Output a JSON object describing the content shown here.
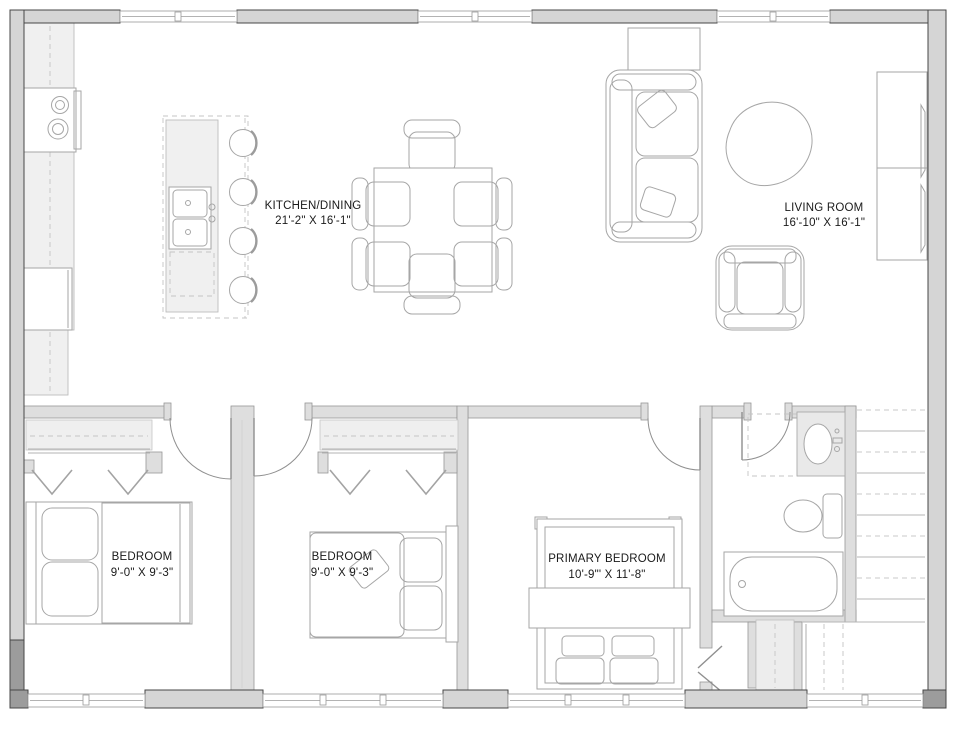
{
  "plan": {
    "rooms": [
      {
        "id": "kitchen_dining",
        "label": "KITCHEN/DINING",
        "dimensions": "21'-2\" X 16'-1\""
      },
      {
        "id": "living_room",
        "label": "LIVING ROOM",
        "dimensions": "16'-10\" X 16'-1\""
      },
      {
        "id": "bedroom_1",
        "label": "BEDROOM",
        "dimensions": "9'-0\" X 9'-3\""
      },
      {
        "id": "bedroom_2",
        "label": "BEDROOM",
        "dimensions": "9'-0\" X 9'-3\""
      },
      {
        "id": "primary_bedroom",
        "label": "PRIMARY BEDROOM",
        "dimensions": "10'-9\"' X 11'-8\""
      }
    ],
    "fixtures": {
      "kitchen": [
        "range-cooktop",
        "wall-counter",
        "island-double-sink",
        "dishwasher",
        "bar-stool",
        "bar-stool",
        "bar-stool",
        "bar-stool"
      ],
      "dining": [
        "dining-table",
        "dining-chairs-x6"
      ],
      "living": [
        "console-table",
        "sofa",
        "coffee-table",
        "armchair",
        "media-cabinet"
      ],
      "bedroom_1": [
        "bed",
        "closet-with-hangers"
      ],
      "bedroom_2": [
        "bed",
        "closet-with-hangers"
      ],
      "primary_bedroom": [
        "bed"
      ],
      "bathroom": [
        "vanity-sink",
        "toilet",
        "bathtub"
      ],
      "circulation": [
        "staircase",
        "under-stair-closet"
      ]
    },
    "colors": {
      "background": "#ffffff",
      "exterior_wall_fill": "#d5d5d5",
      "exterior_wall_outline": "#474747",
      "interior_wall_fill": "#dedede",
      "furniture_line": "#a6a6a6",
      "counter_fill": "#f0f0f0",
      "label_text": "#1a1a1a"
    }
  }
}
